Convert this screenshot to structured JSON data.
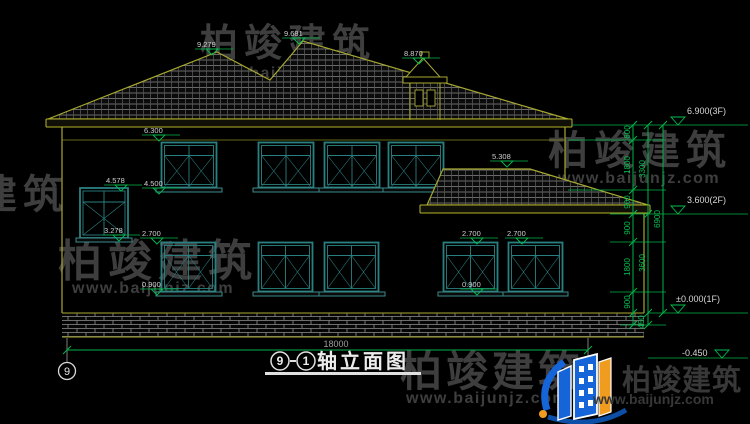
{
  "watermark": {
    "brand": "柏竣建筑",
    "url": "www.baijunjz.com"
  },
  "logo": {
    "brand": "柏竣建筑",
    "url": "www.baijunjz.com"
  },
  "title_block": {
    "grid_start": "9",
    "grid_end": "1",
    "name": "轴立面图"
  },
  "axis": {
    "left_grid": "9",
    "right_grid": "1"
  },
  "levels": {
    "f3": "6.900(3F)",
    "f2": "3.600(2F)",
    "f1": "±0.000(1F)",
    "ground": "-0.450"
  },
  "markers": {
    "ridge_left": "9.279",
    "ridge_main": "9.681",
    "chimney": "8.870",
    "eave": "6.300",
    "stair_window_top": "4.578",
    "sill_2f": "4.500",
    "stair_window_bottom": "3.278",
    "lintel_1f_left": "2.700",
    "sill_1f_left": "0.900",
    "annex_roof": "5.308",
    "lintel_1f_right1": "2.700",
    "lintel_1f_right2": "2.700",
    "sill_1f_right": "0.900"
  },
  "dimensions": {
    "segments": [
      "600",
      "1800",
      "900",
      "900",
      "1800",
      "900"
    ],
    "plinth": "450",
    "floor_heights": [
      "3300",
      "3600"
    ],
    "total_height": "6900",
    "total_width": "18000"
  },
  "colors": {
    "line_yellow": "#a8a832",
    "window_teal": "#2a8080",
    "dim_green": "#00b44a",
    "logo_blue": "#1565d8",
    "logo_orange": "#f09c1e"
  }
}
